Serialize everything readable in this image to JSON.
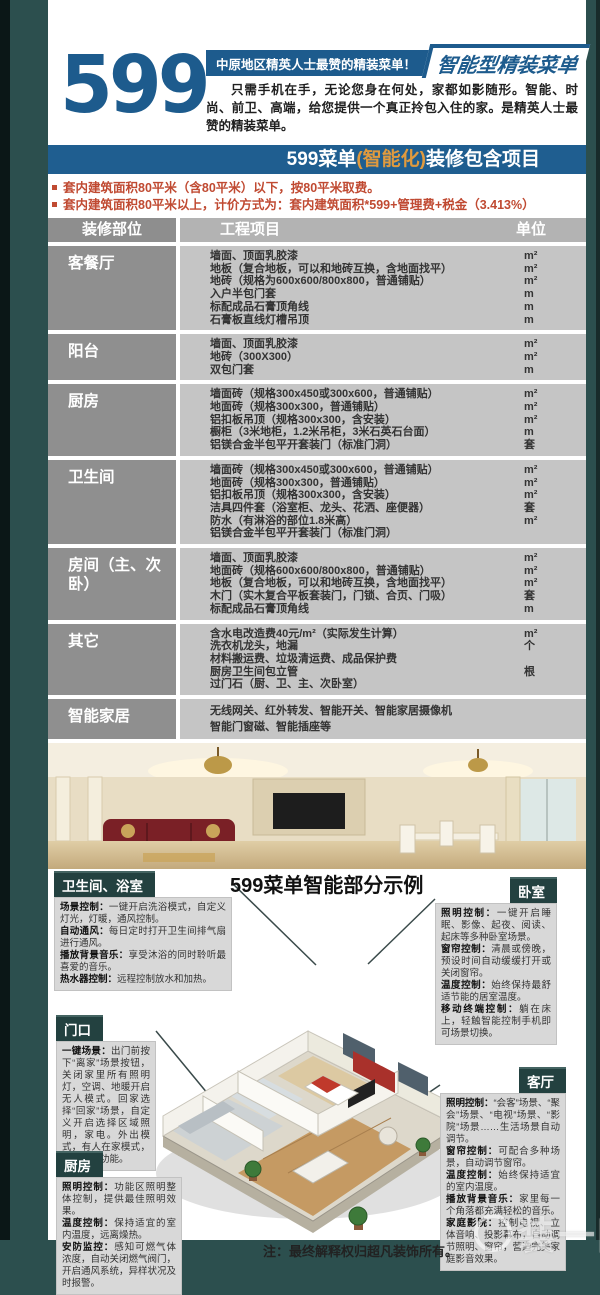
{
  "header": {
    "big_number": "599",
    "tagline": "中原地区精英人士最赞的精装菜单！",
    "ribbon": "智能型精装菜单",
    "intro": "只需手机在手，无论您身在何处，家都如影随形。智能、时尚、前卫、高端，给您提供一个真正拎包入住的家。是精英人士最赞的精装菜单。"
  },
  "banner": {
    "prefix": "599菜单",
    "highlight": "(智能化)",
    "suffix": "装修包含项目"
  },
  "notes": [
    "套内建筑面积80平米（含80平米）以下，按80平米取费。",
    "套内建筑面积80平米以上，计价方式为：套内建筑面积*599+管理费+税金（3.413%）"
  ],
  "table": {
    "headers": [
      "装修部位",
      "工程项目",
      "单位"
    ],
    "sections": [
      {
        "area": "客餐厅",
        "items": [
          {
            "t": "墙面、顶面乳胶漆",
            "u": "m²"
          },
          {
            "t": "地板（复合地板，可以和地砖互换，含地面找平）",
            "u": "m²"
          },
          {
            "t": "地砖（规格为600x600/800x800，普通铺贴）",
            "u": "m²"
          },
          {
            "t": "入户半包门套",
            "u": "m"
          },
          {
            "t": "标配成品石膏顶角线",
            "u": "m"
          },
          {
            "t": "石膏板直线灯槽吊顶",
            "u": "m"
          }
        ]
      },
      {
        "area": "阳台",
        "items": [
          {
            "t": "墙面、顶面乳胶漆",
            "u": "m²"
          },
          {
            "t": "地砖（300X300）",
            "u": "m²"
          },
          {
            "t": "双包门套",
            "u": "m"
          }
        ]
      },
      {
        "area": "厨房",
        "items": [
          {
            "t": "墙面砖（规格300x450或300x600，普通铺贴）",
            "u": "m²"
          },
          {
            "t": "地面砖（规格300x300，普通铺贴）",
            "u": "m²"
          },
          {
            "t": "铝扣板吊顶（规格300x300，含安装）",
            "u": "m²"
          },
          {
            "t": "橱柜（3米地柜，1.2米吊柜，3米石英石台面）",
            "u": "m"
          },
          {
            "t": "铝镁合金半包平开套装门（标准门洞）",
            "u": "套"
          }
        ]
      },
      {
        "area": "卫生间",
        "items": [
          {
            "t": "墙面砖（规格300x450或300x600，普通铺贴）",
            "u": "m²"
          },
          {
            "t": "地面砖（规格300x300，普通铺贴）",
            "u": "m²"
          },
          {
            "t": "铝扣板吊顶（规格300x300，含安装）",
            "u": "m²"
          },
          {
            "t": "洁具四件套（浴室柜、龙头、花洒、座便器）",
            "u": "套"
          },
          {
            "t": "防水（有淋浴的部位1.8米高）",
            "u": "m²"
          },
          {
            "t": "铝镁合金半包平开套装门（标准门洞）",
            "u": ""
          }
        ]
      },
      {
        "area": "房间（主、次卧）",
        "items": [
          {
            "t": "墙面、顶面乳胶漆",
            "u": "m²"
          },
          {
            "t": "地面砖（规格600x600/800x800，普通铺贴）",
            "u": "m²"
          },
          {
            "t": "地板（复合地板，可以和地砖互换，含地面找平）",
            "u": "m²"
          },
          {
            "t": "木门（实木复合平板套装门，门锁、合页、门吸）",
            "u": "套"
          },
          {
            "t": "标配成品石膏顶角线",
            "u": "m"
          }
        ]
      },
      {
        "area": "其它",
        "items": [
          {
            "t": "含水电改造费40元/m²（实际发生计算）",
            "u": "m²"
          },
          {
            "t": "洗衣机龙头，地漏",
            "u": "个"
          },
          {
            "t": "材料搬运费、垃圾清运费、成品保护费",
            "u": ""
          },
          {
            "t": "厨房卫生间包立管",
            "u": "根"
          },
          {
            "t": "过门石（厨、卫、主、次卧室）",
            "u": ""
          }
        ]
      },
      {
        "area": "智能家居",
        "items": [
          {
            "t": "无线网关、红外转发、智能开关、智能家居摄像机",
            "u": ""
          },
          {
            "t": "智能门窗磁、智能插座等",
            "u": ""
          }
        ]
      }
    ]
  },
  "showcase": {
    "title": "599菜单智能部分示例",
    "callouts": {
      "bathroom": {
        "title": "卫生间、浴室",
        "lines": [
          {
            "label": "场景控制：",
            "text": "一键开启洗浴模式，自定义灯光，灯暖，通风控制。"
          },
          {
            "label": "自动通风：",
            "text": "每日定时打开卫生间排气扇进行通风。"
          },
          {
            "label": "播放背景音乐：",
            "text": "享受沐浴的同时聆听最喜爱的音乐。"
          },
          {
            "label": "热水器控制：",
            "text": "远程控制放水和加热。"
          }
        ]
      },
      "entrance": {
        "title": "门口",
        "lines": [
          {
            "label": "一键场景：",
            "text": "出门前按下“离家”场景按钮，关闭家里所有照明灯，空调、地暖开启无人模式。回家选择“回家”场景，自定义开启选择区域照明，家电。外出模式，有人在家模式，实现防盗功能。"
          }
        ]
      },
      "kitchen": {
        "title": "厨房",
        "lines": [
          {
            "label": "照明控制：",
            "text": "功能区照明整体控制，提供最佳照明效果。"
          },
          {
            "label": "温度控制：",
            "text": "保持适宜的室内温度，远离燥热。"
          },
          {
            "label": "安防监控：",
            "text": "感知可燃气体浓度，自动关闭燃气阀门，开启通风系统，异样状况及时报警。"
          }
        ]
      },
      "bedroom": {
        "title": "卧室",
        "lines": [
          {
            "label": "照明控制：",
            "text": "一键开启睡眠、影像、起夜、阅读、起床等多种卧室场景。"
          },
          {
            "label": "窗帘控制：",
            "text": "清晨或傍晚，预设时间自动缓缓打开或关闭窗帘。"
          },
          {
            "label": "温度控制：",
            "text": "始终保持最舒适节能的居室温度。"
          },
          {
            "label": "移动终端控制：",
            "text": "躺在床上，轻触智能控制手机即可场景切换。"
          }
        ]
      },
      "living": {
        "title": "客厅",
        "lines": [
          {
            "label": "照明控制：",
            "text": "“会客”场景、“聚会”场景、“电视”场景、“影院”场景……生活场景自动调节。"
          },
          {
            "label": "窗帘控制：",
            "text": "可配合多种场景，自动调节窗帘。"
          },
          {
            "label": "温度控制：",
            "text": "始终保持适宜的室内温度。"
          },
          {
            "label": "播放背景音乐：",
            "text": "家里每一个角落都充满轻松的音乐。"
          },
          {
            "label": "家庭影院：",
            "text": "控制电视、立体音响、投影幕布，自动调节照明、窗帘，营造完美家庭影音效果。"
          }
        ]
      }
    }
  },
  "footer": {
    "note": "注：最终解释权归超凡装饰所有。",
    "watermark": "装一网"
  },
  "colors": {
    "brand_blue": "#1d5b8d",
    "banner_blue": "#1f5e90",
    "highlight_orange": "#e09a3e",
    "note_red": "#c04a32",
    "frame_teal": "#2c4f4e",
    "callout_header": "#234140"
  }
}
